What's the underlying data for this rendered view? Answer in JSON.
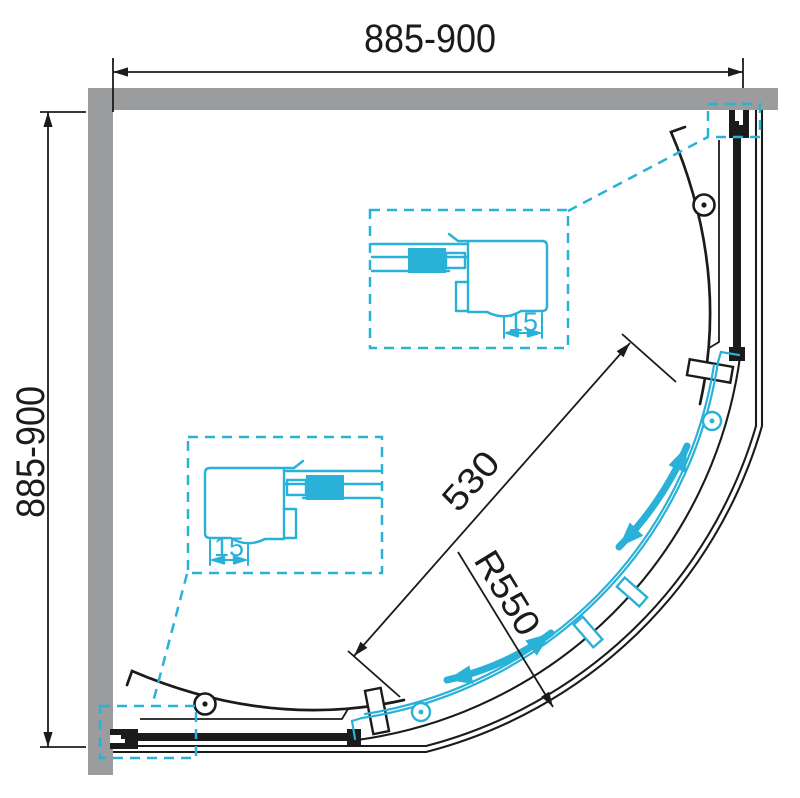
{
  "page": {
    "title": "Quadrant corner shower enclosure – plan view technical drawing"
  },
  "drawing": {
    "type": "technical-drawing",
    "subject": "quarter-round corner shower enclosure with curved sliding doors",
    "dimensions": {
      "width_top": "885-900",
      "depth_left": "885-900",
      "entry_opening": "530",
      "radius": "R550",
      "profile_adjustment_upper": "15",
      "profile_adjustment_lower": "15"
    },
    "colors": {
      "accent": "#29b1d7",
      "wall": "#9b9c9e",
      "line": "#1b1b1b",
      "background": "#ffffff"
    }
  }
}
